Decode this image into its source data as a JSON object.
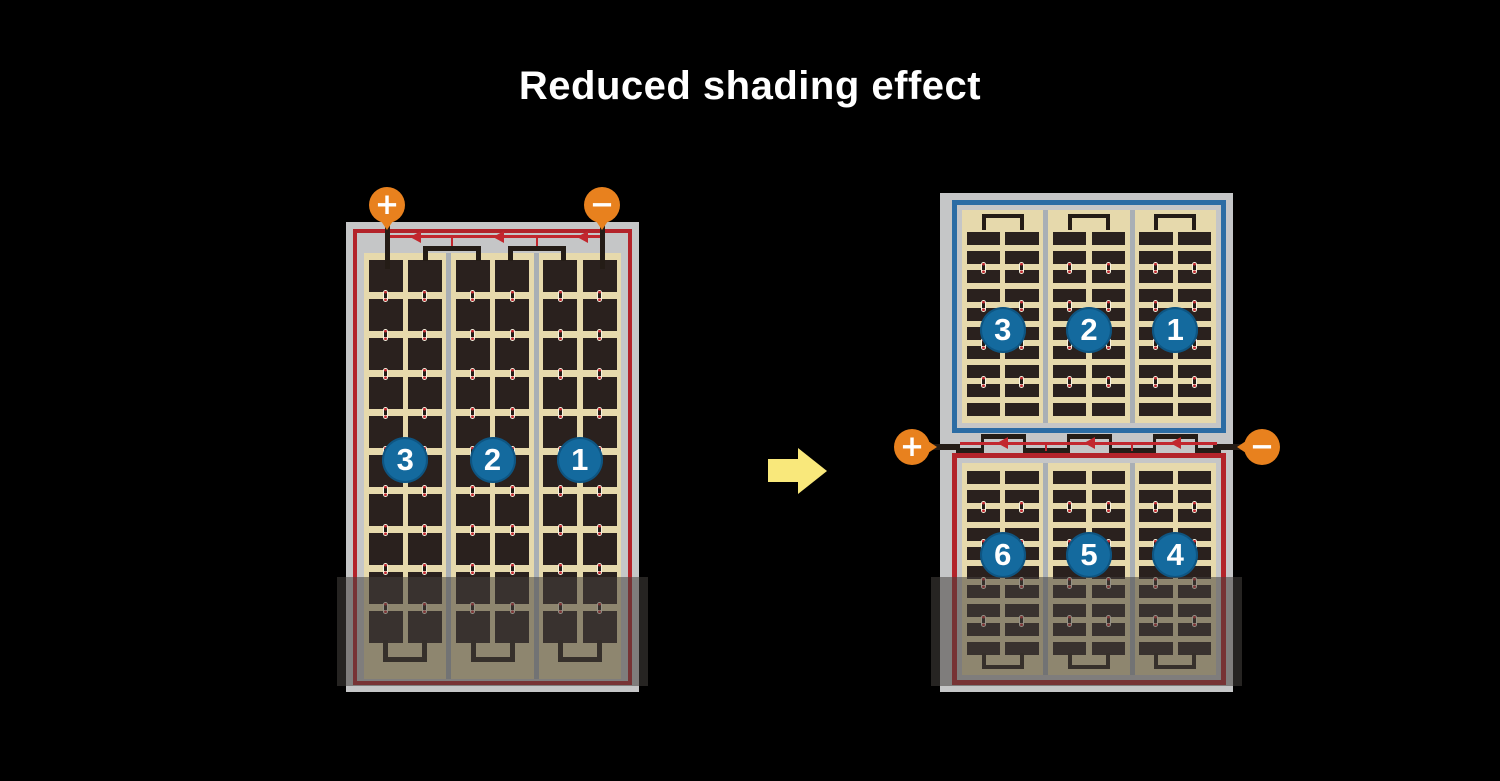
{
  "title": "Reduced shading effect",
  "colors": {
    "background": "#000000",
    "title_text": "#ffffff",
    "terminal_orange": "#e8811e",
    "wire_red": "#b3232a",
    "diode_red": "#c2272e",
    "string_blue_border": "#2b6ca4",
    "panel_frame_gray": "#c5c6c7",
    "cell_divider_gray": "#a9afb5",
    "cell_background_cream": "#e6d9ac",
    "cell_dark": "#2a211e",
    "wire_black": "#241c16",
    "badge_blue": "#146a9e",
    "arrow_yellow": "#f9e87b",
    "shading_overlay": "rgba(70,66,62,0.55)"
  },
  "icons": {
    "transition_arrow": "right-arrow",
    "bypass_diode": "left-pointing-triangle"
  },
  "before_module": {
    "terminals": {
      "positive": "+",
      "negative": "−"
    },
    "strings": [
      "3",
      "2",
      "1"
    ],
    "cell_columns": 6,
    "cell_rows": 10,
    "bypass_diodes": 3,
    "shaded": true
  },
  "after_module": {
    "terminals": {
      "positive": "+",
      "negative": "−"
    },
    "top_half_strings": [
      "3",
      "2",
      "1"
    ],
    "bottom_half_strings": [
      "6",
      "5",
      "4"
    ],
    "cell_columns": 6,
    "cell_rows_per_half": 10,
    "bypass_diodes": 3,
    "shaded": true
  }
}
